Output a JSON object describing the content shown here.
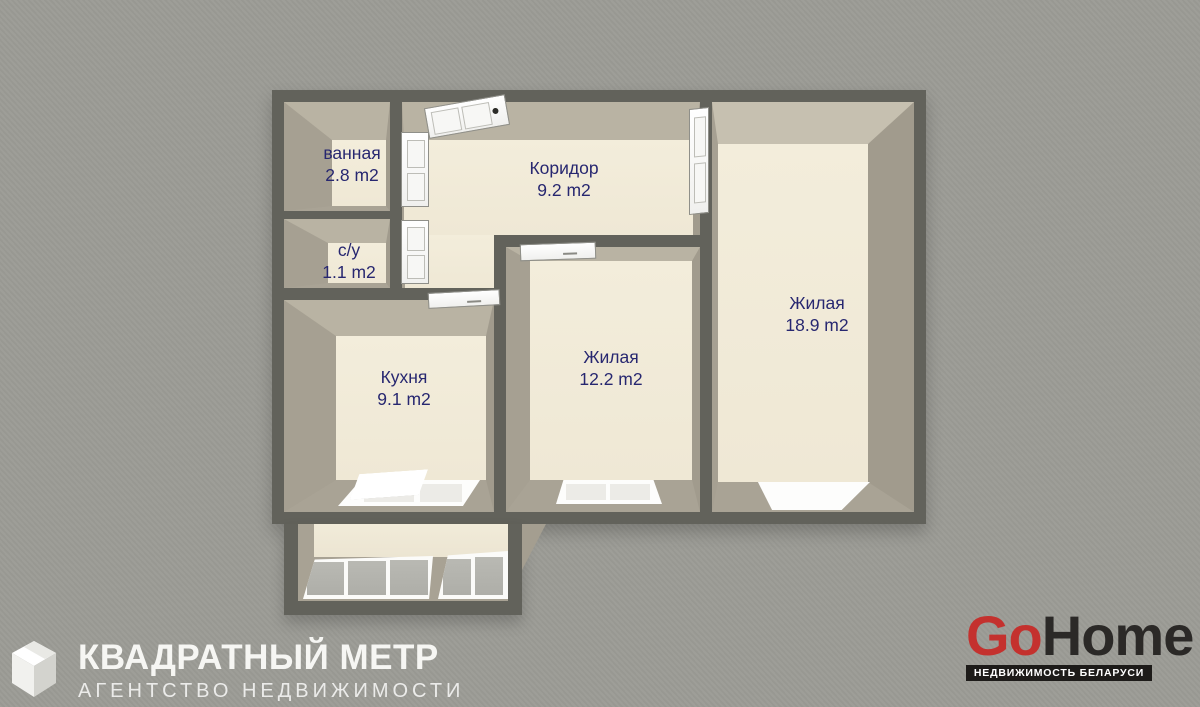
{
  "plan": {
    "rooms": [
      {
        "name": "ванная",
        "area": "2.8 m2"
      },
      {
        "name": "с/у",
        "area": "1.1 m2"
      },
      {
        "name": "Коридор",
        "area": "9.2 m2"
      },
      {
        "name": "Кухня",
        "area": "9.1 m2"
      },
      {
        "name": "Жилая",
        "area": "12.2 m2"
      },
      {
        "name": "Жилая",
        "area": "18.9 m2"
      }
    ],
    "label_color": "#272770",
    "wall_color": "#62625b",
    "wall_face_color": "#a9a395",
    "floor_color": "#f1ebd9",
    "background_color": "#9c9c96"
  },
  "agency": {
    "title": "КВАДРАТНЫЙ МЕТР",
    "subtitle": "АГЕНТСТВО НЕДВИЖИМОСТИ",
    "icon": "cube-logo",
    "text_color": "#f6f6f3"
  },
  "portal": {
    "brand_prefix": "Go",
    "brand_suffix": "Home",
    "prefix_color": "#c4312e",
    "suffix_color": "#2b2927",
    "tagline": "НЕДВИЖИМОСТЬ БЕЛАРУСИ",
    "tagline_bg": "#1d1b19",
    "tagline_color": "#ffffff"
  }
}
